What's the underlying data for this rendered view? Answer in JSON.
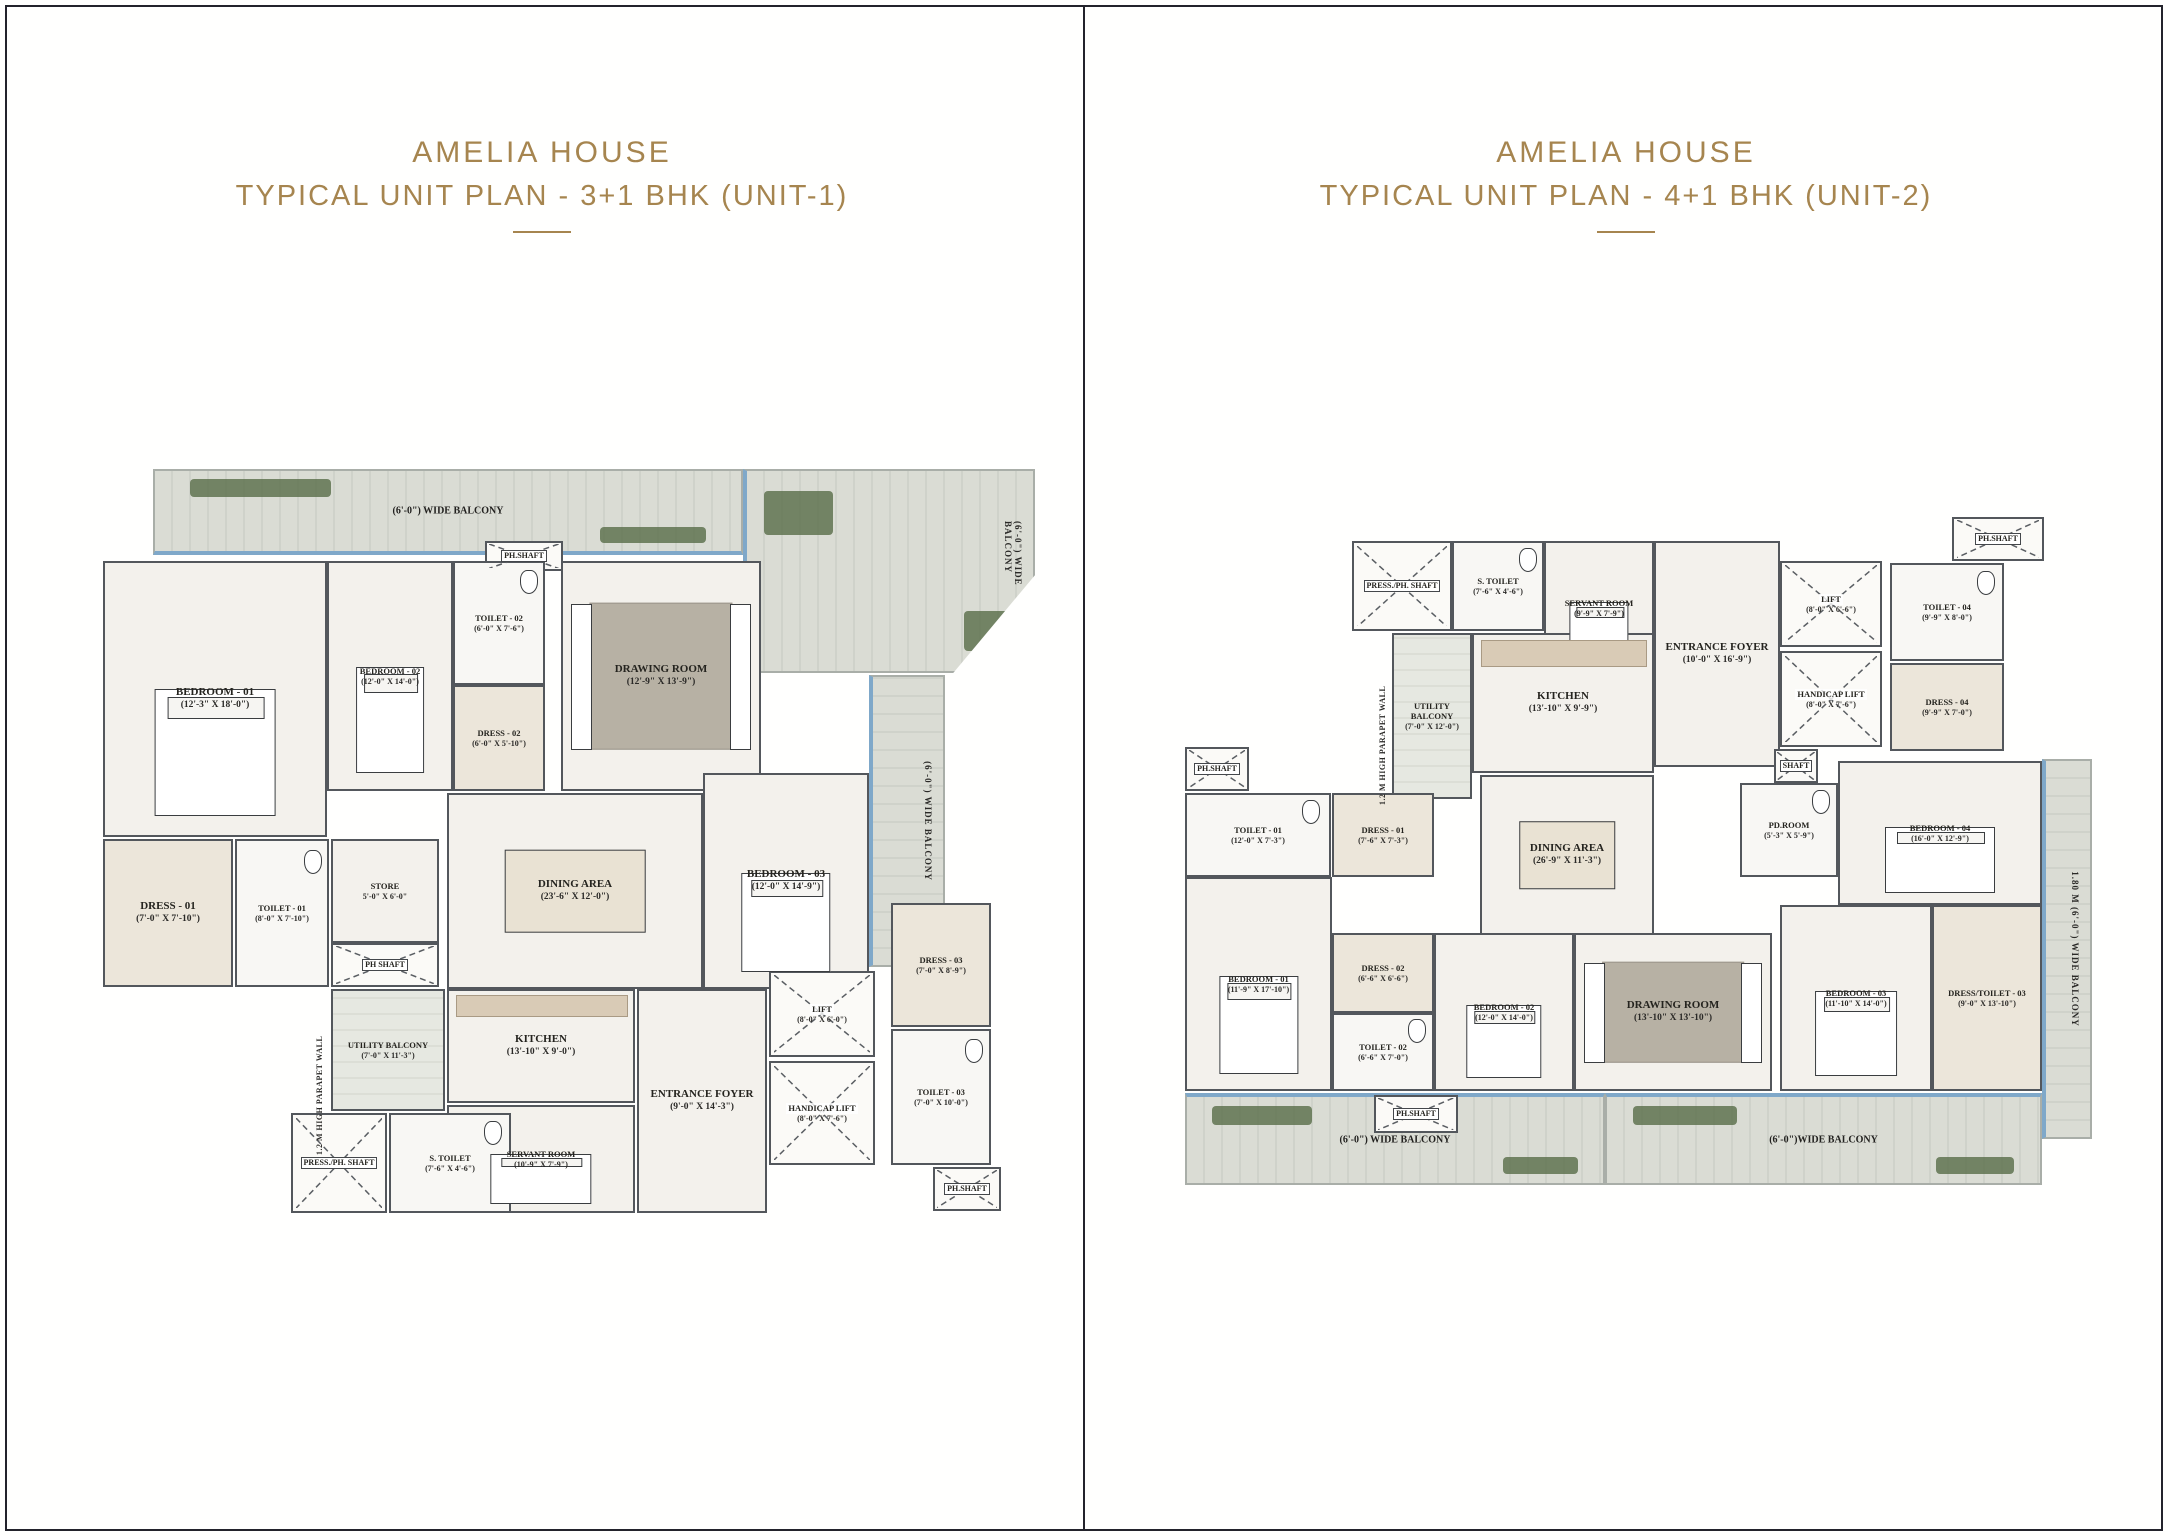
{
  "colors": {
    "accent_gold": "#a6854f",
    "wall": "#53575c",
    "floor": "#f3f1ec",
    "deck": "#d8dad2",
    "window_blue": "#7fa8c9",
    "plant_green": "#5f7350",
    "frame": "#23232c"
  },
  "panels": [
    {
      "title_line1": "AMELIA HOUSE",
      "title_line2": "TYPICAL UNIT PLAN - 3+1 BHK (UNIT-1)",
      "plan": {
        "x": 95,
        "y": 455,
        "w": 945,
        "h": 760,
        "decks": [
          {
            "x": 58,
            "y": 14,
            "w": 590,
            "h": 86,
            "label": "(6'-0\") WIDE BALCONY",
            "edge": "bottom",
            "plants": true
          },
          {
            "x": 648,
            "y": 14,
            "w": 292,
            "h": 204,
            "vlabel": "(6'-0\") WIDE BALCONY",
            "edge": "left",
            "plants": true,
            "notch": true
          },
          {
            "x": 774,
            "y": 220,
            "w": 76,
            "h": 292,
            "vlabel": "(6'-0\") WIDE BALCONY",
            "edge": "left",
            "vert": true
          }
        ],
        "rooms": [
          {
            "n": "PH.SHAFT",
            "x": 390,
            "y": 86,
            "w": 78,
            "h": 30,
            "k": "shaft",
            "small": true
          },
          {
            "n": "BEDROOM - 01",
            "d": "(12'-3\" X 18'-0\")",
            "x": 8,
            "y": 106,
            "w": 224,
            "h": 276,
            "k": "bedroom"
          },
          {
            "n": "BEDROOM - 02",
            "d": "(12'-0\" X 14'-0\")",
            "x": 232,
            "y": 106,
            "w": 126,
            "h": 230,
            "k": "bedroom",
            "small": true
          },
          {
            "n": "TOILET - 02",
            "d": "(6'-0\" X 7'-6\")",
            "x": 358,
            "y": 106,
            "w": 92,
            "h": 124,
            "k": "toilet",
            "small": true
          },
          {
            "n": "DRESS - 02",
            "d": "(6'-0\" X 5'-10\")",
            "x": 358,
            "y": 230,
            "w": 92,
            "h": 106,
            "k": "dress",
            "small": true
          },
          {
            "n": "DRAWING ROOM",
            "d": "(12'-9\" X 13'-9\")",
            "x": 466,
            "y": 106,
            "w": 200,
            "h": 230,
            "k": "drawing"
          },
          {
            "n": "BEDROOM - 03",
            "d": "(12'-0\" X 14'-9\")",
            "x": 608,
            "y": 318,
            "w": 166,
            "h": 216,
            "k": "bedroom"
          },
          {
            "n": "DINING AREA",
            "d": "(23'-6\" X 12'-0\")",
            "x": 352,
            "y": 338,
            "w": 256,
            "h": 196,
            "k": "dining"
          },
          {
            "n": "DRESS - 01",
            "d": "(7'-0\" X 7'-10\")",
            "x": 8,
            "y": 384,
            "w": 130,
            "h": 148,
            "k": "dress"
          },
          {
            "n": "TOILET - 01",
            "d": "(8'-0\" X 7'-10\")",
            "x": 140,
            "y": 384,
            "w": 94,
            "h": 148,
            "k": "toilet",
            "small": true
          },
          {
            "n": "STORE",
            "d": "5'-0\" X 6'-0\"",
            "x": 236,
            "y": 384,
            "w": 108,
            "h": 104,
            "k": "room",
            "small": true
          },
          {
            "n": "PH SHAFT",
            "x": 236,
            "y": 488,
            "w": 108,
            "h": 44,
            "k": "shaft",
            "small": true
          },
          {
            "n": "UTILITY BALCONY",
            "d": "(7'-0\" X 11'-3\")",
            "x": 236,
            "y": 534,
            "w": 114,
            "h": 122,
            "k": "balcony-room",
            "small": true
          },
          {
            "n": "KITCHEN",
            "d": "(13'-10\" X 9'-0\")",
            "x": 352,
            "y": 534,
            "w": 188,
            "h": 114,
            "k": "kitchen"
          },
          {
            "n": "SERVANT ROOM",
            "d": "(10'-9\" X 7'-9\")",
            "x": 352,
            "y": 650,
            "w": 188,
            "h": 108,
            "k": "bedroom",
            "small": true
          },
          {
            "n": "PRESS./PH. SHAFT",
            "x": 196,
            "y": 658,
            "w": 96,
            "h": 100,
            "k": "shaft",
            "small": true
          },
          {
            "n": "S. TOILET",
            "d": "(7'-6\" X 4'-6\")",
            "x": 294,
            "y": 658,
            "w": 122,
            "h": 100,
            "k": "toilet",
            "small": true
          },
          {
            "n": "ENTRANCE FOYER",
            "d": "(9'-0\" X 14'-3\")",
            "x": 542,
            "y": 534,
            "w": 130,
            "h": 224,
            "k": "room"
          },
          {
            "n": "LIFT",
            "d": "(8'-0\" X 6'-0\")",
            "x": 674,
            "y": 516,
            "w": 106,
            "h": 86,
            "k": "lift",
            "small": true
          },
          {
            "n": "HANDICAP LIFT",
            "d": "(8'-0\" X 7'-6\")",
            "x": 674,
            "y": 606,
            "w": 106,
            "h": 104,
            "k": "lift",
            "small": true
          },
          {
            "n": "DRESS - 03",
            "d": "(7'-0\" X 8'-9\")",
            "x": 796,
            "y": 448,
            "w": 100,
            "h": 124,
            "k": "dress",
            "small": true
          },
          {
            "n": "TOILET - 03",
            "d": "(7'-0\" X 10'-0\")",
            "x": 796,
            "y": 574,
            "w": 100,
            "h": 136,
            "k": "toilet",
            "small": true
          },
          {
            "n": "PH.SHAFT",
            "x": 838,
            "y": 712,
            "w": 68,
            "h": 44,
            "k": "shaft",
            "small": true
          }
        ],
        "vlabels": [
          {
            "text": "1.2 M HIGH PARAPET WALL",
            "x": 220,
            "y": 540,
            "h": 160
          }
        ]
      }
    },
    {
      "title_line1": "AMELIA HOUSE",
      "title_line2": "TYPICAL UNIT PLAN - 4+1 BHK (UNIT-2)",
      "plan": {
        "x": 96,
        "y": 505,
        "w": 915,
        "h": 685,
        "decks": [
          {
            "x": 5,
            "y": 588,
            "w": 420,
            "h": 92,
            "label": "(6'-0\") WIDE BALCONY",
            "edge": "top",
            "plants": true
          },
          {
            "x": 425,
            "y": 588,
            "w": 437,
            "h": 92,
            "label": "(6'-0\")WIDE BALCONY",
            "edge": "top",
            "plants": true
          },
          {
            "x": 862,
            "y": 254,
            "w": 50,
            "h": 380,
            "vlabel": "1.80 M (6'-0\") WIDE BALCONY",
            "edge": "left",
            "vert": true
          }
        ],
        "rooms": [
          {
            "n": "PRESS./PH. SHAFT",
            "x": 172,
            "y": 36,
            "w": 100,
            "h": 90,
            "k": "shaft",
            "small": true
          },
          {
            "n": "S. TOILET",
            "d": "(7'-6\" X 4'-6\")",
            "x": 272,
            "y": 36,
            "w": 92,
            "h": 90,
            "k": "toilet",
            "small": true
          },
          {
            "n": "SERVANT ROOM",
            "d": "(9'-9\" X 7'-9\")",
            "x": 364,
            "y": 36,
            "w": 110,
            "h": 134,
            "k": "bedroom",
            "small": true
          },
          {
            "n": "ENTRANCE FOYER",
            "d": "(10'-0\" X 16'-9\")",
            "x": 474,
            "y": 36,
            "w": 126,
            "h": 226,
            "k": "room"
          },
          {
            "n": "LIFT",
            "d": "(8'-0\" X 6'-6\")",
            "x": 600,
            "y": 56,
            "w": 102,
            "h": 86,
            "k": "lift",
            "small": true
          },
          {
            "n": "HANDICAP LIFT",
            "d": "(8'-0\" X 7'-6\")",
            "x": 600,
            "y": 146,
            "w": 102,
            "h": 96,
            "k": "lift",
            "small": true
          },
          {
            "n": "PH.SHAFT",
            "x": 772,
            "y": 12,
            "w": 92,
            "h": 44,
            "k": "shaft",
            "small": true
          },
          {
            "n": "TOILET - 04",
            "d": "(9'-9\" X 8'-0\")",
            "x": 710,
            "y": 58,
            "w": 114,
            "h": 98,
            "k": "toilet",
            "small": true
          },
          {
            "n": "DRESS - 04",
            "d": "(9'-9\" X 7'-0\")",
            "x": 710,
            "y": 158,
            "w": 114,
            "h": 88,
            "k": "dress",
            "small": true
          },
          {
            "n": "SHAFT",
            "x": 594,
            "y": 244,
            "w": 44,
            "h": 34,
            "k": "shaft",
            "small": true
          },
          {
            "n": "UTILITY BALCONY",
            "d": "(7'-0\" X 12'-0\")",
            "x": 212,
            "y": 128,
            "w": 80,
            "h": 166,
            "k": "balcony-room",
            "small": true
          },
          {
            "n": "KITCHEN",
            "d": "(13'-10\" X 9'-9\")",
            "x": 292,
            "y": 128,
            "w": 182,
            "h": 140,
            "k": "kitchen"
          },
          {
            "n": "PH.SHAFT",
            "x": 5,
            "y": 242,
            "w": 64,
            "h": 44,
            "k": "shaft",
            "small": true
          },
          {
            "n": "TOILET - 01",
            "d": "(12'-0\" X 7'-3\")",
            "x": 5,
            "y": 288,
            "w": 146,
            "h": 84,
            "k": "toilet",
            "small": true
          },
          {
            "n": "DRESS - 01",
            "d": "(7'-6\" X 7'-3\")",
            "x": 152,
            "y": 288,
            "w": 102,
            "h": 84,
            "k": "dress",
            "small": true
          },
          {
            "n": "DINING AREA",
            "d": "(26'-9\" X 11'-3\")",
            "x": 300,
            "y": 270,
            "w": 174,
            "h": 160,
            "k": "dining"
          },
          {
            "n": "BEDROOM - 01",
            "d": "(11'-9\" X 17'-10\")",
            "x": 5,
            "y": 372,
            "w": 147,
            "h": 214,
            "k": "bedroom",
            "small": true
          },
          {
            "n": "DRESS - 02",
            "d": "(6'-6\" X 6'-6\")",
            "x": 152,
            "y": 428,
            "w": 102,
            "h": 80,
            "k": "dress",
            "small": true
          },
          {
            "n": "TOILET - 02",
            "d": "(6'-6\" X 7'-0\")",
            "x": 152,
            "y": 508,
            "w": 102,
            "h": 78,
            "k": "toilet",
            "small": true
          },
          {
            "n": "BEDROOM - 02",
            "d": "(12'-0\" X 14'-0\")",
            "x": 254,
            "y": 428,
            "w": 140,
            "h": 158,
            "k": "bedroom",
            "small": true
          },
          {
            "n": "DRAWING ROOM",
            "d": "(13'-10\" X 13'-10\")",
            "x": 394,
            "y": 428,
            "w": 198,
            "h": 158,
            "k": "drawing"
          },
          {
            "n": "PD.ROOM",
            "d": "(5'-3\" X 5'-9\")",
            "x": 560,
            "y": 278,
            "w": 98,
            "h": 94,
            "k": "toilet",
            "small": true
          },
          {
            "n": "BEDROOM - 04",
            "d": "(16'-0\" X 12'-9\")",
            "x": 658,
            "y": 256,
            "w": 204,
            "h": 144,
            "k": "bedroom",
            "small": true
          },
          {
            "n": "BEDROOM - 03",
            "d": "(11'-10\" X 14'-0\")",
            "x": 600,
            "y": 400,
            "w": 152,
            "h": 186,
            "k": "bedroom",
            "small": true
          },
          {
            "n": "DRESS/TOILET - 03",
            "d": "(9'-0\" X 13'-10\")",
            "x": 752,
            "y": 400,
            "w": 110,
            "h": 186,
            "k": "dress",
            "small": true
          },
          {
            "n": "PH.SHAFT",
            "x": 194,
            "y": 590,
            "w": 84,
            "h": 38,
            "k": "shaft",
            "small": true
          }
        ],
        "vlabels": [
          {
            "text": "1.2 M HIGH PARAPET WALL",
            "x": 198,
            "y": 140,
            "h": 160
          }
        ]
      }
    }
  ]
}
